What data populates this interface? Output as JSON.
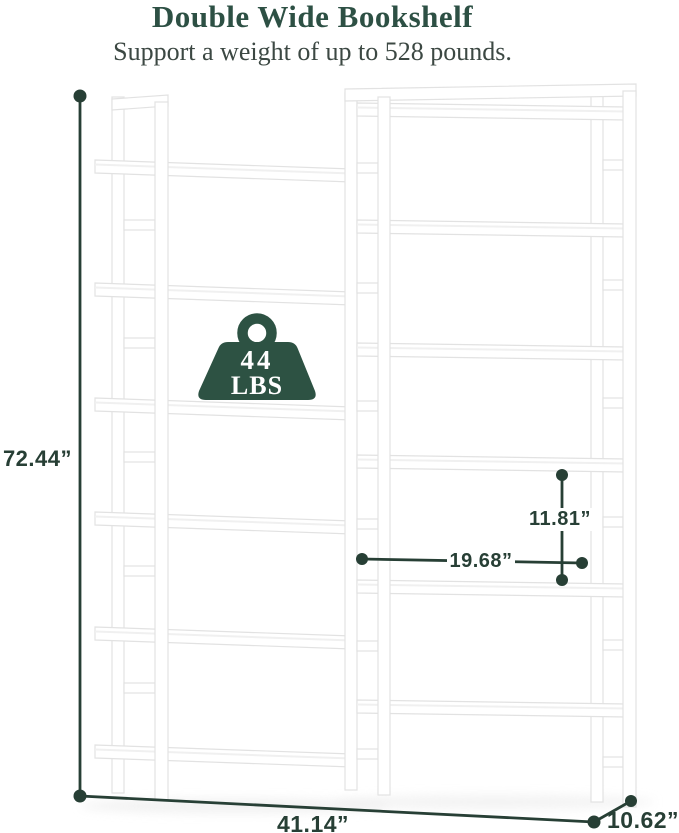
{
  "header": {
    "title": "Double Wide Bookshelf",
    "subtitle": "Support a weight of up to 528 pounds."
  },
  "weight_badge": {
    "value": "44",
    "unit": "LBS"
  },
  "dimensions": {
    "overall_height": "72.44”",
    "overall_width": "41.14”",
    "depth": "10.62”",
    "inner_shelf_height": "11.81”",
    "inner_shelf_width": "19.68”"
  },
  "colors": {
    "accent_green": "#2d5243",
    "dimension_line": "#273f35",
    "title_text": "#2d5044",
    "subtitle_text": "#3c4843",
    "furniture_edge": "#e2e2e2",
    "background": "#ffffff"
  }
}
